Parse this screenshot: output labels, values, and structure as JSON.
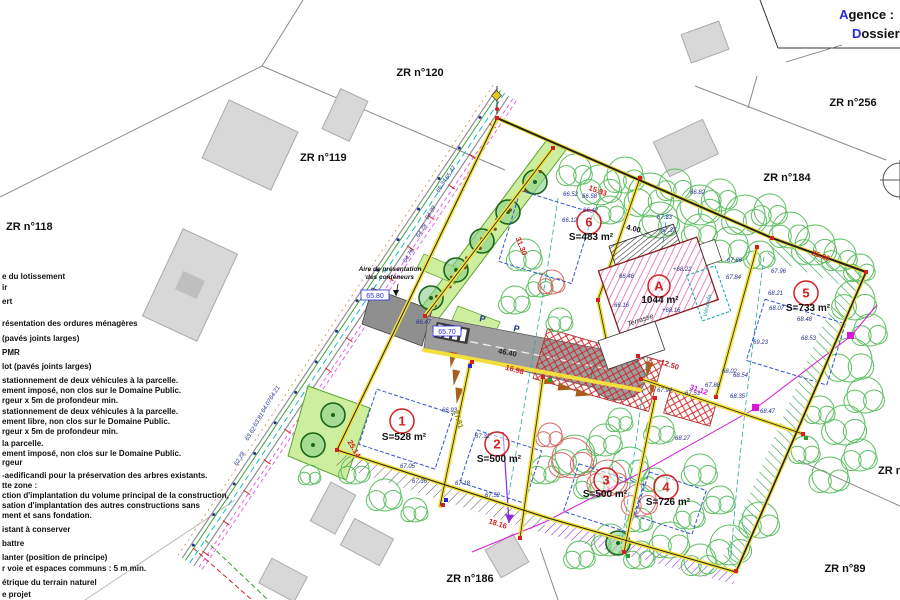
{
  "title_block": {
    "agence_first": "A",
    "agence_rest": "gence :",
    "dossier_first": "D",
    "dossier_rest": "ossier"
  },
  "parcels": [
    {
      "label": "ZR n°120",
      "x": 420,
      "y": 76,
      "anchor": "middle"
    },
    {
      "label": "ZR n°119",
      "x": 300,
      "y": 161,
      "anchor": "start"
    },
    {
      "label": "ZR n°118",
      "x": 6,
      "y": 230,
      "anchor": "start"
    },
    {
      "label": "ZR n°256",
      "x": 853,
      "y": 106,
      "anchor": "middle"
    },
    {
      "label": "ZR n°184",
      "x": 787,
      "y": 181,
      "anchor": "middle"
    },
    {
      "label": "ZR n°89",
      "x": 845,
      "y": 572,
      "anchor": "middle"
    },
    {
      "label": "ZR n°186",
      "x": 470,
      "y": 582,
      "anchor": "middle"
    },
    {
      "label": "ZR n",
      "x": 878,
      "y": 474,
      "anchor": "start"
    }
  ],
  "legend": {
    "items": [
      {
        "y": 279,
        "text": "e du lotissement"
      },
      {
        "y": 290,
        "text": "ir"
      },
      {
        "y": 304,
        "text": "ert"
      },
      {
        "y": 326,
        "text": "résentation des ordures ménagères"
      },
      {
        "y": 341,
        "text": "(pavés joints larges)"
      },
      {
        "y": 355,
        "text": "PMR"
      },
      {
        "y": 369,
        "text": "lot (pavés joints larges)"
      },
      {
        "y": 383,
        "text": "stationnement de deux véhicules à la parcelle."
      },
      {
        "y": 393,
        "text": "ement imposé, non clos sur le Domaine Public."
      },
      {
        "y": 403,
        "text": "rgeur x 5m de profondeur min."
      },
      {
        "y": 414,
        "text": "stationnement de deux véhicules à la parcelle."
      },
      {
        "y": 424,
        "text": "ement libre, non clos sur le Domaine Public."
      },
      {
        "y": 434,
        "text": "rgeur x 5m de profondeur min."
      },
      {
        "y": 446,
        "text": "la parcelle."
      },
      {
        "y": 456,
        "text": "ement imposé, non clos sur le Domaine Public."
      },
      {
        "y": 465,
        "text": "rgeur"
      },
      {
        "y": 478,
        "text": "-aedificandi pour la préservation des arbres existants."
      },
      {
        "y": 488,
        "text": "tte zone :"
      },
      {
        "y": 498,
        "text": "ction d'implantation du volume principal de la construction,"
      },
      {
        "y": 508,
        "text": "sation d'implantation des autres constructions sans"
      },
      {
        "y": 518,
        "text": "ment et sans fondation."
      },
      {
        "y": 532,
        "text": "istant à conserver"
      },
      {
        "y": 546,
        "text": "battre"
      },
      {
        "y": 560,
        "text": "lanter (position de principe)"
      },
      {
        "y": 571,
        "text": "r voie et espaces communs : 5 m min."
      },
      {
        "y": 585,
        "text": "étrique du terrain naturel"
      },
      {
        "y": 597,
        "text": "e projet"
      }
    ]
  },
  "lots": [
    {
      "num": "1",
      "x": 402,
      "y": 421,
      "r": 12,
      "area": "S=528 m²",
      "ax": 404,
      "ay": 440
    },
    {
      "num": "2",
      "x": 497,
      "y": 444,
      "r": 12,
      "area": "S=500 m²",
      "ax": 499,
      "ay": 462
    },
    {
      "num": "3",
      "x": 606,
      "y": 480,
      "r": 12,
      "area": "S=500 m²",
      "ax": 605,
      "ay": 497
    },
    {
      "num": "4",
      "x": 666,
      "y": 487,
      "r": 12,
      "area": "S=726 m²",
      "ax": 668,
      "ay": 505
    },
    {
      "num": "5",
      "x": 806,
      "y": 293,
      "r": 12,
      "area": "S=733 m²",
      "ax": 808,
      "ay": 311
    },
    {
      "num": "6",
      "x": 589,
      "y": 222,
      "r": 12,
      "area": "S=483 m²",
      "ax": 591,
      "ay": 240
    },
    {
      "num": "A",
      "x": 659,
      "y": 286,
      "r": 11,
      "area": "1044 m²",
      "ax": 660,
      "ay": 303
    }
  ],
  "building": {
    "terrasse": "Terrasse",
    "veranda": "Véranda"
  },
  "annotations": {
    "containers_line1": "Aire de présentation",
    "containers_line2": "des conteneurs",
    "cx": 390,
    "cy": 271,
    "parking_label": "P",
    "parking": [
      {
        "x": 479,
        "y": 321
      },
      {
        "x": 513,
        "y": 331
      }
    ]
  },
  "boxed_levels": [
    {
      "t": "65.80",
      "x": 375,
      "y": 297
    },
    {
      "t": "65.70",
      "x": 447,
      "y": 333
    }
  ],
  "dimensions": [
    {
      "t": "15.93",
      "x": 597,
      "y": 193,
      "r": 20,
      "c": "#d42020"
    },
    {
      "t": "25.06",
      "x": 820,
      "y": 258,
      "r": 20,
      "c": "#d42020"
    },
    {
      "t": "31.12",
      "x": 698,
      "y": 392,
      "r": 19,
      "c": "#d817d8"
    },
    {
      "t": "12.50",
      "x": 669,
      "y": 367,
      "r": 18,
      "c": "#d42020"
    },
    {
      "t": "16.98",
      "x": 514,
      "y": 372,
      "r": 15,
      "c": "#d42020"
    },
    {
      "t": "25.14",
      "x": 352,
      "y": 450,
      "r": 60,
      "c": "#d42020"
    },
    {
      "t": "18.16",
      "x": 497,
      "y": 526,
      "r": 18,
      "c": "#d42020"
    },
    {
      "t": "31.30",
      "x": 519,
      "y": 247,
      "r": 68,
      "c": "#d42020"
    },
    {
      "t": "27.81",
      "x": 456,
      "y": 420,
      "r": 72,
      "c": "#8a8a00"
    },
    {
      "t": "46.40",
      "x": 507,
      "y": 355,
      "r": 11,
      "c": "#222222"
    },
    {
      "t": "4.00",
      "x": 633,
      "y": 231,
      "r": 14,
      "c": "#111111"
    }
  ],
  "levels": [
    [
      563,
      196,
      "66.52"
    ],
    [
      582,
      198,
      "66.58"
    ],
    [
      583,
      212,
      "66.42"
    ],
    [
      562,
      222,
      "66.12"
    ],
    [
      657,
      219,
      "67.33"
    ],
    [
      661,
      232,
      "67.37"
    ],
    [
      690,
      194,
      "66.82"
    ],
    [
      727,
      262,
      "67.86"
    ],
    [
      726,
      279,
      "67.84"
    ],
    [
      619,
      278,
      "66.46"
    ],
    [
      614,
      307,
      "66.16"
    ],
    [
      673,
      271,
      "+68.22"
    ],
    [
      662,
      312,
      "+68.16"
    ],
    [
      771,
      273,
      "67.96"
    ],
    [
      768,
      295,
      "68.21"
    ],
    [
      769,
      310,
      "68.07"
    ],
    [
      797,
      321,
      "68.48"
    ],
    [
      801,
      340,
      "68.53"
    ],
    [
      753,
      344,
      "69.23"
    ],
    [
      722,
      373,
      "68.02"
    ],
    [
      733,
      377,
      "68.54"
    ],
    [
      730,
      398,
      "68.35"
    ],
    [
      760,
      413,
      "68.47"
    ],
    [
      705,
      387,
      "67.88"
    ],
    [
      685,
      395,
      "67.53"
    ],
    [
      657,
      392,
      "67.94"
    ],
    [
      675,
      440,
      "68.27"
    ],
    [
      442,
      412,
      "66.93"
    ],
    [
      475,
      438,
      "67.32"
    ],
    [
      400,
      468,
      "67.05"
    ],
    [
      412,
      483,
      "67.36"
    ],
    [
      455,
      485,
      "67.18"
    ],
    [
      485,
      497,
      "67.52"
    ],
    [
      416,
      324,
      "66.47"
    ]
  ],
  "road_levels": [
    [
      448,
      180,
      "65.47"
    ],
    [
      439,
      193,
      "65.34"
    ],
    [
      428,
      220,
      "64.39"
    ],
    [
      419,
      238,
      "64.28"
    ],
    [
      406,
      263,
      "64.76"
    ],
    [
      272,
      400,
      "64.21"
    ],
    [
      264,
      413,
      "64.07"
    ],
    [
      256,
      427,
      "63.81"
    ],
    [
      248,
      441,
      "63.62"
    ],
    [
      237,
      466,
      "62.28"
    ]
  ],
  "colors": {
    "yellow": "#f2df3c",
    "red": "#d42020",
    "pink": "#e060a8",
    "green_hatch": "#2f9e44",
    "purple": "#8a2be2",
    "road_gray": "#9d9d9d",
    "tree_green": "#5cbf60",
    "planted_green": "#196619",
    "navy": "#24308f",
    "magenta": "#d817d8",
    "blue": "#2a2ad4"
  }
}
